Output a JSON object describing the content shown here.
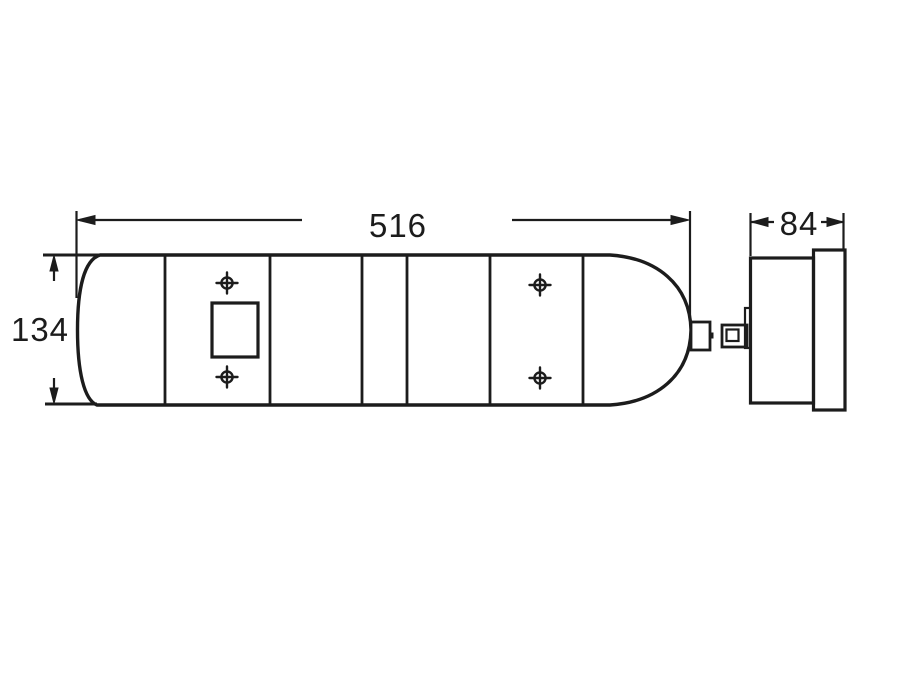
{
  "drawing": {
    "background_color": "#ffffff",
    "line_color": "#1c1c1c",
    "views": {
      "front": {
        "name": "front-view",
        "width_dimension": {
          "value": "516"
        },
        "height_dimension": {
          "value": "134"
        }
      },
      "side": {
        "name": "side-view",
        "depth_dimension": {
          "value": "84"
        }
      }
    },
    "icons": [
      "position-target-icon",
      "dimension-arrow-icon",
      "square-cutout",
      "connector-plug-icon"
    ]
  }
}
